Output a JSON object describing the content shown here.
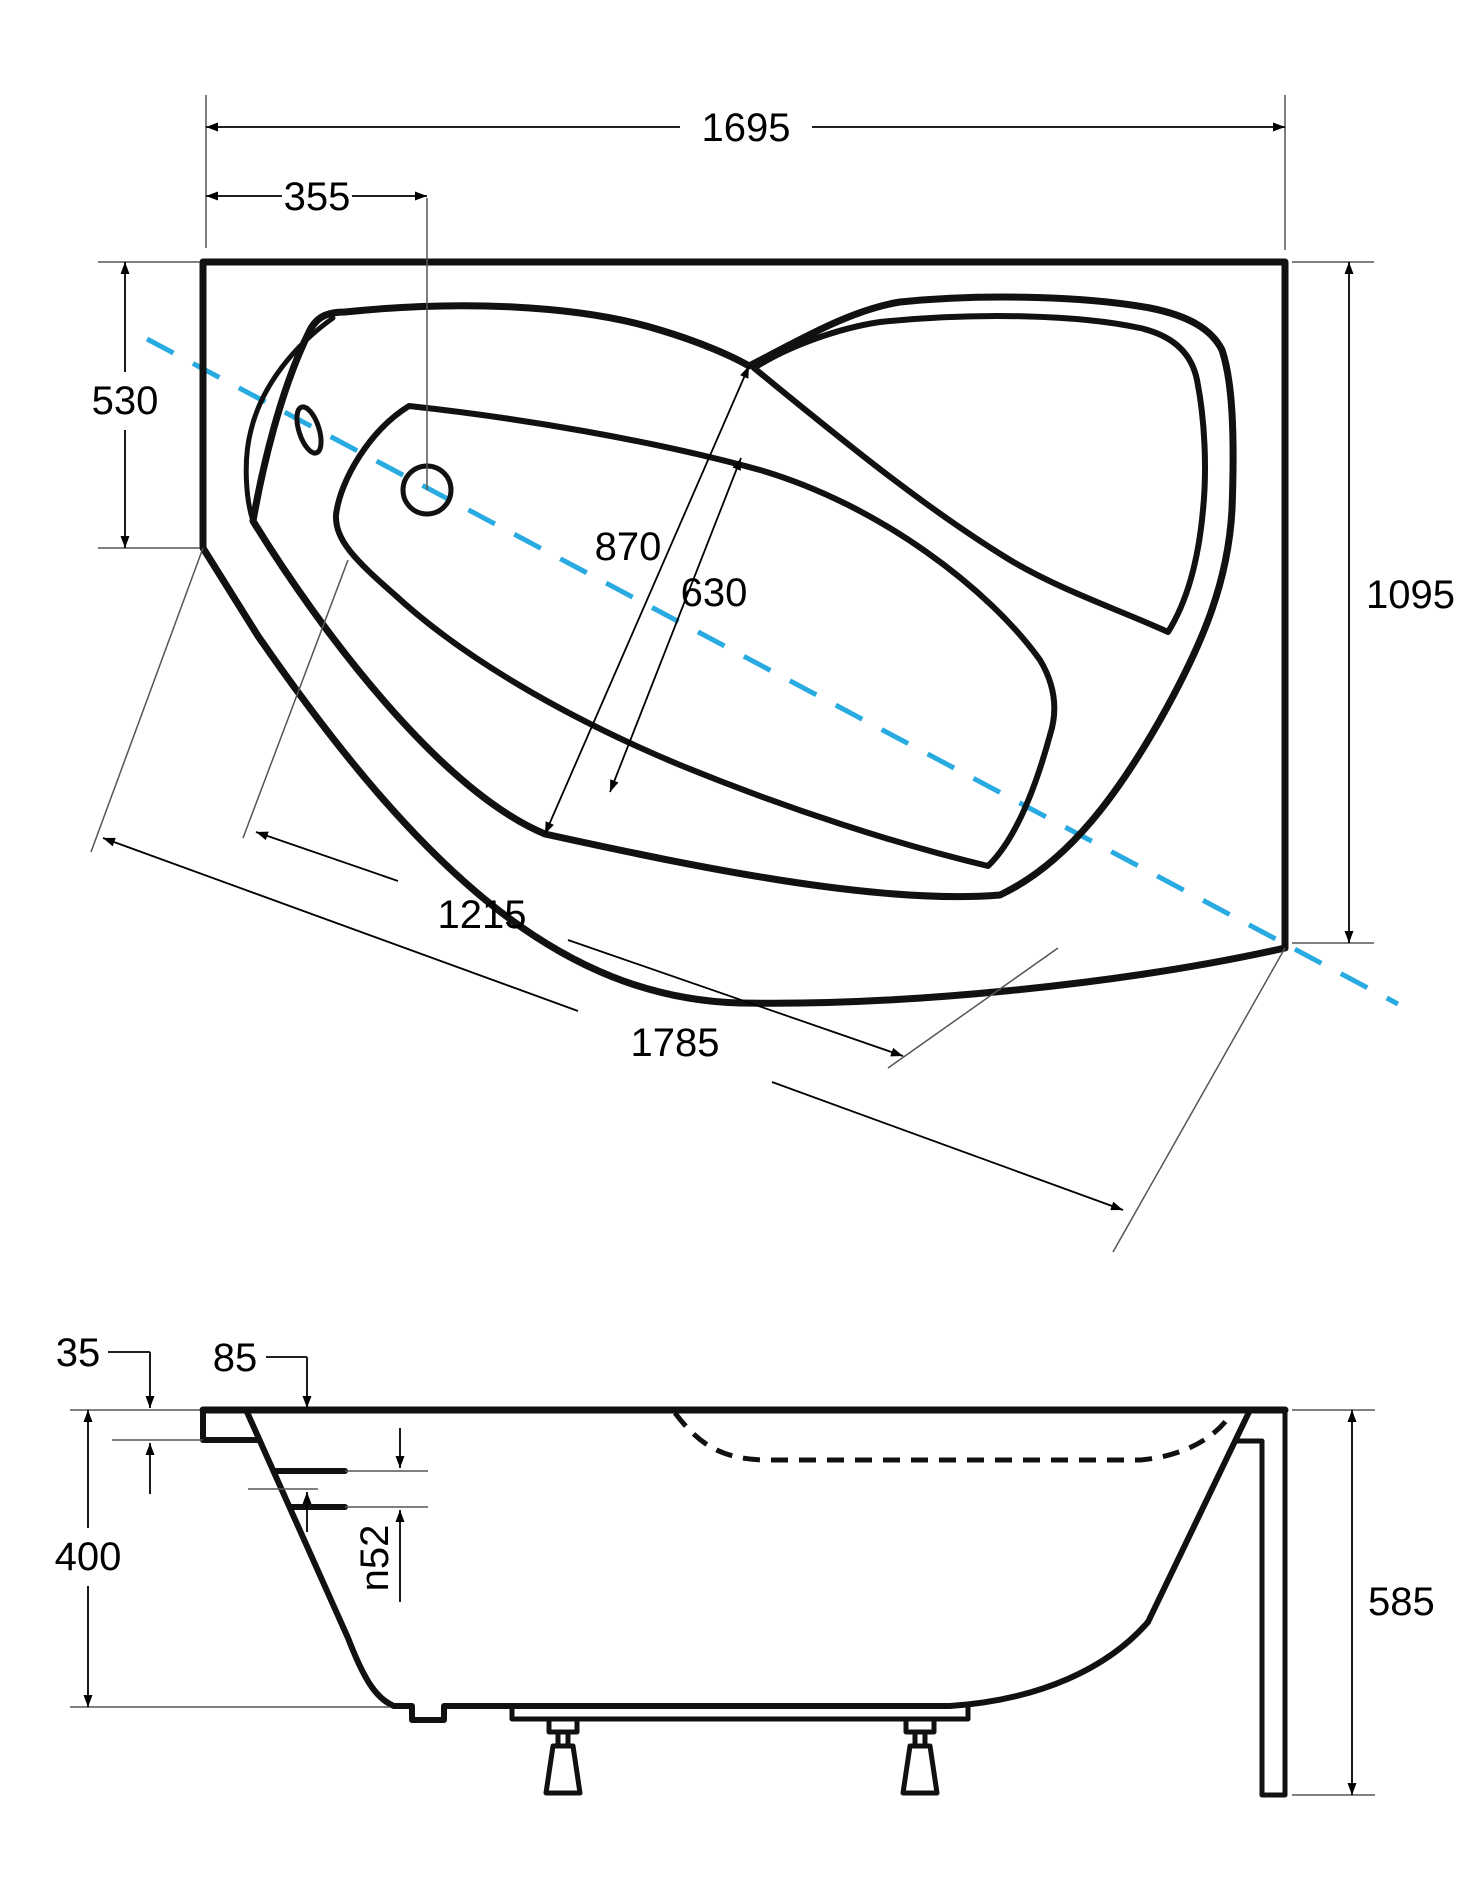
{
  "drawing": {
    "colors": {
      "line": "#111111",
      "center_axis": "#29abe2"
    },
    "top_view": {
      "dims": {
        "overall_width": "1695",
        "hole_offset": "355",
        "left_side_depth": "530",
        "right_side_depth": "1095",
        "opening_width": "870",
        "basin_width": "630",
        "inner_diagonal": "1215",
        "outer_diagonal": "1785"
      }
    },
    "side_view": {
      "dims": {
        "rim_lip_height": "35",
        "hole_center_offset": "85",
        "tub_depth": "400",
        "hole_diameter": "n52",
        "overall_height": "585"
      }
    }
  }
}
